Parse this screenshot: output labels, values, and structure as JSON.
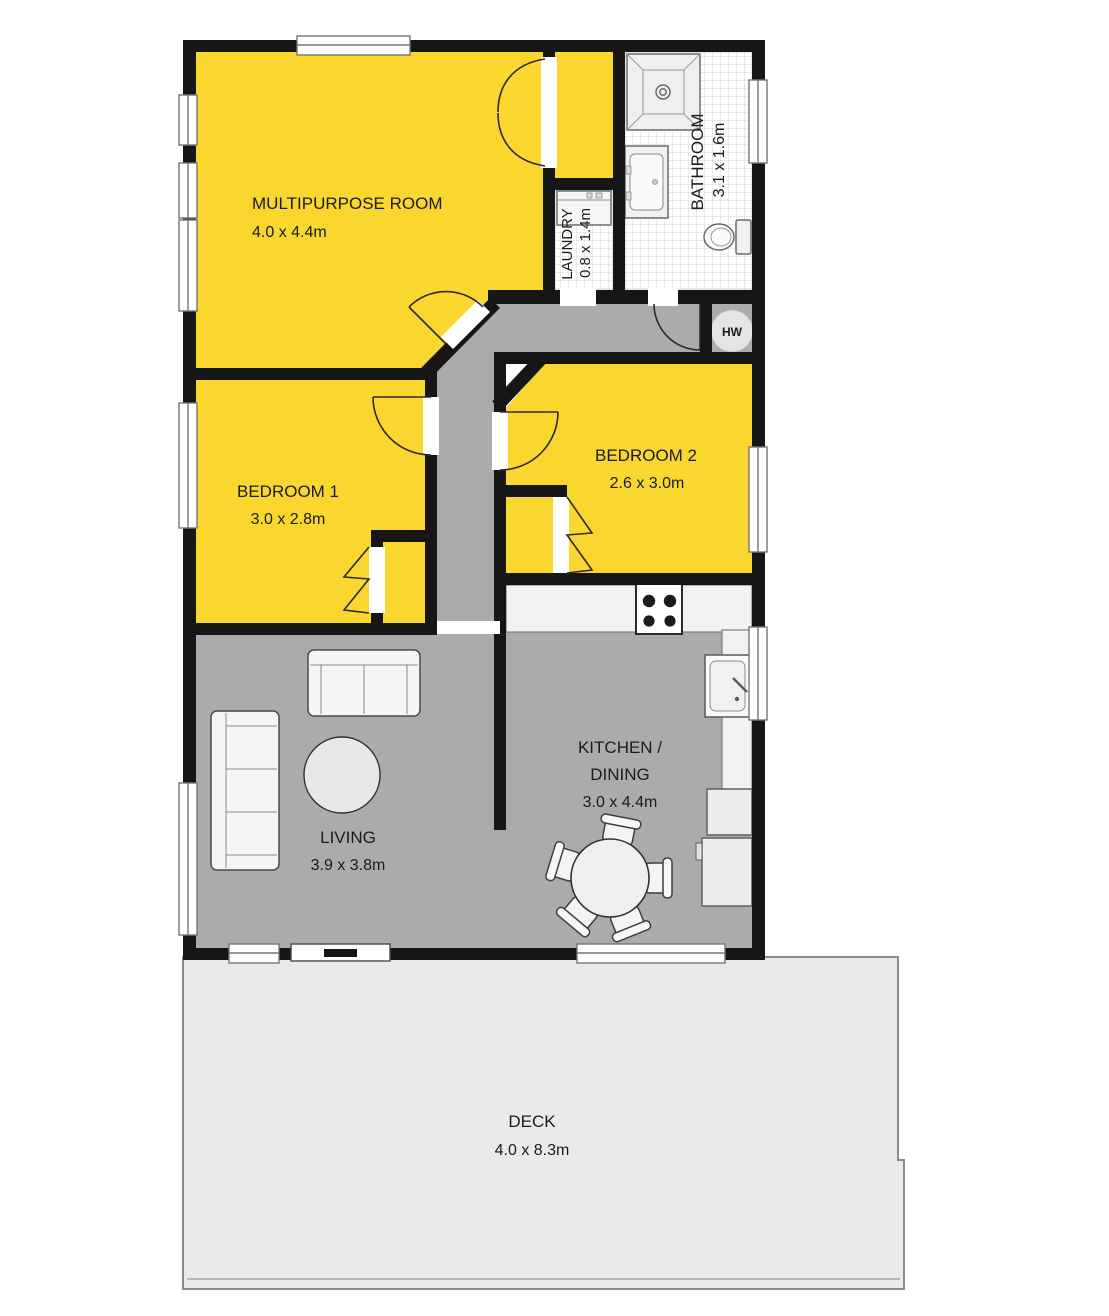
{
  "plan": {
    "rooms": {
      "multipurpose": {
        "name": "MULTIPURPOSE ROOM",
        "dims": "4.0 x 4.4m"
      },
      "bathroom": {
        "name": "BATHROOM",
        "dims": "3.1 x 1.6m"
      },
      "laundry": {
        "name": "LAUNDRY",
        "dims": "0.8 x 1.4m"
      },
      "bedroom1": {
        "name": "BEDROOM 1",
        "dims": "3.0 x 2.8m"
      },
      "bedroom2": {
        "name": "BEDROOM 2",
        "dims": "2.6 x 3.0m"
      },
      "kitchen_dining": {
        "name_line1": "KITCHEN /",
        "name_line2": "DINING",
        "dims": "3.0 x 4.4m"
      },
      "living": {
        "name": "LIVING",
        "dims": "3.9 x 3.8m"
      },
      "deck": {
        "name": "DECK",
        "dims": "4.0 x 8.3m"
      }
    },
    "labels": {
      "hot_water": "HW"
    },
    "colors": {
      "room_highlight": "#F9D72F",
      "floor_gray": "#ABABAB",
      "deck_gray": "#EAEAEA",
      "wall": "#161616",
      "tile_line": "#D4D4D4",
      "furniture_fill": "#F4F4F4"
    }
  }
}
